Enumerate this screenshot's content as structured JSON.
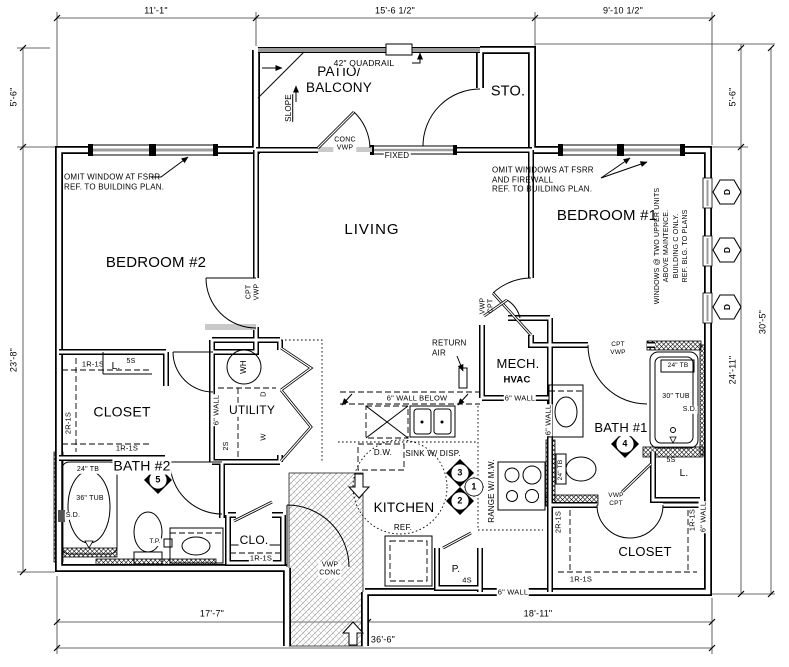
{
  "colors": {
    "line": "#000000",
    "rail": "#9c9c9c",
    "dim": "#3a3a3a",
    "bg": "#ffffff"
  },
  "dims": {
    "t1": "11'-1\"",
    "t2": "15'-6 1/2\"",
    "t3": "9'-10 1/2\"",
    "l1": "5'-6\"",
    "l2": "23'-8\"",
    "r1": "5'-6\"",
    "r2": "30'-5\"",
    "r3": "24'-11\"",
    "b1": "17'-7\"",
    "b2": "18'-11\"",
    "b3": "36'-6\""
  },
  "rooms": {
    "patio": "PATIO/\nBALCONY",
    "sto": "STO.",
    "bedroom2": "BEDROOM #2",
    "living": "LIVING",
    "bedroom1": "BEDROOM #1",
    "closet_left": "CLOSET",
    "utility": "UTILITY",
    "bath2": "BATH #2",
    "kitchen": "KITCHEN",
    "mech": "MECH.",
    "hvac": "HVAC",
    "bath1": "BATH #1",
    "clo": "CLO.",
    "closet_right": "CLOSET",
    "linen": "L."
  },
  "notes": {
    "omit_left": "OMIT WINDOW AT FSRR\nREF. TO BUILDING PLAN.",
    "omit_right": "OMIT WINDOWS AT FSRR\nAND FIREWALL\nREF. TO BUILDING PLAN.",
    "windows_upper": "WINDOWS @ TWO UPPER UNITS\nABOVE MAINTENCE.\nBUILDING C ONLY.\nREF. BLG. TO PLANS"
  },
  "labels": {
    "quadrail": "42\" QUADRAIL",
    "slope": "SLOPE",
    "conc_vwp": "CONC\nVWP",
    "vwp_conc": "VWP\nCONC",
    "fixed": "FIXED",
    "cpt_vwp": "CPT\nVWP",
    "vwp_cpt": "VWP\nCPT",
    "wall6": "6\" WALL",
    "wall6_below": "6\" WALL BELOW",
    "return_air": "RETURN\nAIR",
    "dw": "D.W.",
    "sink": "SINK W/ DISP.",
    "range": "RANGE W/ M.W.",
    "ref": "REF.",
    "pantry": "P.",
    "s4": "4S",
    "s5": "5S",
    "s2": "2S",
    "r1s1": "1R-1S",
    "r2s1": "2R-1S",
    "tb24": "24\" TB",
    "tub36": "36\" TUB",
    "tub30": "30\" TUB",
    "sd": "S.D.",
    "tp": "T.P.",
    "wh": "WH",
    "washer": "W",
    "dryer": "D"
  },
  "markers": {
    "m1": "1",
    "m2": "2",
    "m3": "3",
    "m4": "4",
    "m5": "5",
    "hex": "D"
  }
}
